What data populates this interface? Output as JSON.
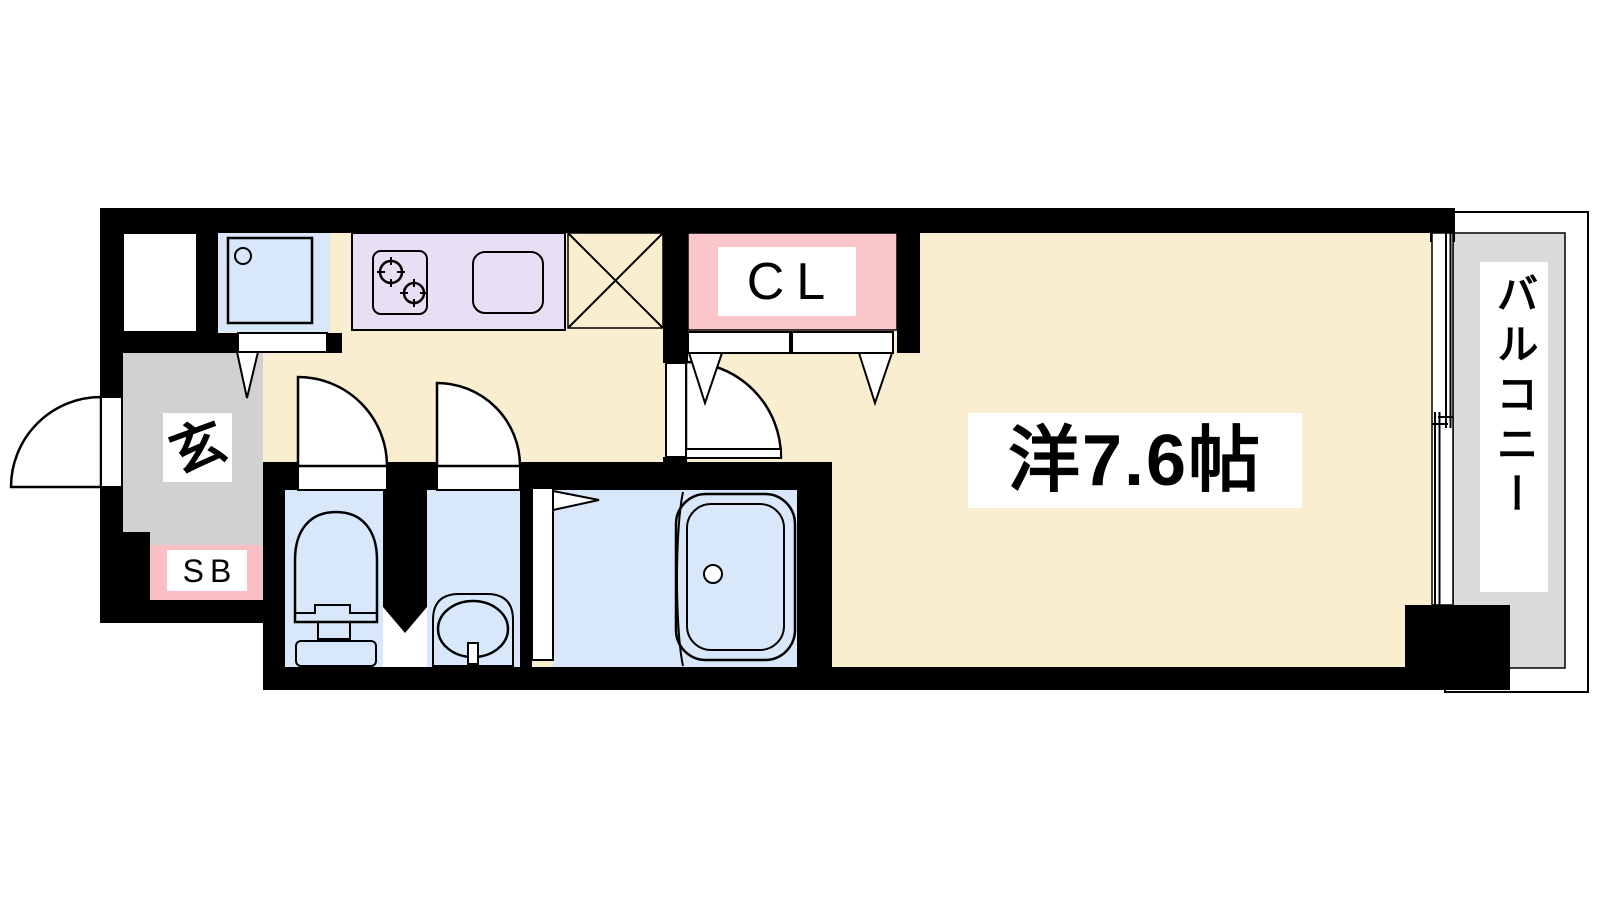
{
  "floor_plan": {
    "labels": {
      "entrance": "玄",
      "shoe_box": "SB",
      "closet": "CL",
      "main_room": "洋7.6帖",
      "balcony": "バルコニー"
    },
    "main_room_size_jo": 7.6,
    "colors": {
      "wall": "#000000",
      "outline": "#000000",
      "floor": "#FAEED0",
      "water_room": "#D8E7FA",
      "kitchen_counter": "#E9DFF4",
      "closet_pink": "#FAC6CA",
      "shoe_box_pink": "#F9BFC5",
      "entrance_gray": "#D1D1D1",
      "balcony_gray": "#DBDBDB",
      "label_background": "#FFFFFF"
    },
    "fixtures": [
      "washing-machine-pan",
      "gas-stove",
      "kitchen-sink",
      "refrigerator-space",
      "closet-folding-doors",
      "entrance-door",
      "hallway-hinged-doors",
      "room-hinged-door",
      "toilet",
      "washbasin",
      "bathtub",
      "bath-folding-door",
      "sliding-window"
    ]
  }
}
